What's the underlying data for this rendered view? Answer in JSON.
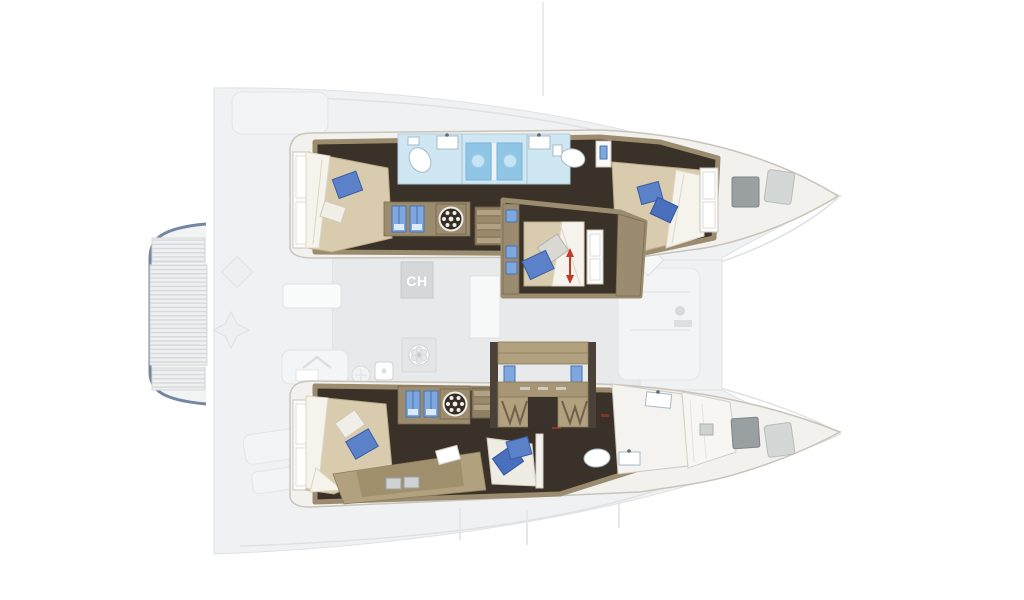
{
  "meta": {
    "title": "Catamaran yacht floor plan — lower deck layout",
    "view": "top-down plan",
    "orientation": "bow to the right, stern to the left"
  },
  "labels": {
    "chart_table": "CH"
  },
  "colors": {
    "floor_dark": "#3a3128",
    "wood_trim": "#9c8c6f",
    "wood_light": "#b2a17e",
    "bed_beige": "#d8cbae",
    "bath_floor": "#cfe7f3",
    "shower_blue": "#8fc6e6",
    "pillow_blue": "#5b82c8",
    "ghost_fill": "#f0f1f2",
    "ghost_stroke": "#dfe1e3",
    "salon_fill": "#e7e9ea",
    "hatch_gray": "#9aa0a2",
    "accent_red": "#c0392b",
    "stern_outline": "#5d7292"
  },
  "rooms": [
    {
      "id": "stern-platform",
      "name": "Stern swim platform with slats"
    },
    {
      "id": "aft-cockpit",
      "name": "Aft cockpit (ghosted deck level)"
    },
    {
      "id": "salon",
      "name": "Salon with chart station and galley (ghosted)"
    },
    {
      "id": "port-aft-cabin",
      "name": "Port hull aft double cabin"
    },
    {
      "id": "port-bathroom",
      "name": "Port hull bathroom with twin heads and two showers"
    },
    {
      "id": "port-forward-cabin",
      "name": "Port hull forward double cabin"
    },
    {
      "id": "forward-master-cabin",
      "name": "Central forward master cabin with dimension arrow"
    },
    {
      "id": "starboard-aft-cabin",
      "name": "Starboard hull aft double cabin"
    },
    {
      "id": "starboard-lounge",
      "name": "Starboard hull vanity desk and settee"
    },
    {
      "id": "starboard-bathroom",
      "name": "Starboard hull forward bathroom with shower"
    },
    {
      "id": "foredeck-lounge",
      "name": "Foredeck lounge (ghosted)"
    }
  ],
  "icons": [
    "washing-machine-icon",
    "vent-fan-icon",
    "toilet-icon",
    "sink-icon",
    "shower-icon",
    "deck-hatch-icon",
    "hanging-locker-icon",
    "dimension-arrow-icon"
  ]
}
